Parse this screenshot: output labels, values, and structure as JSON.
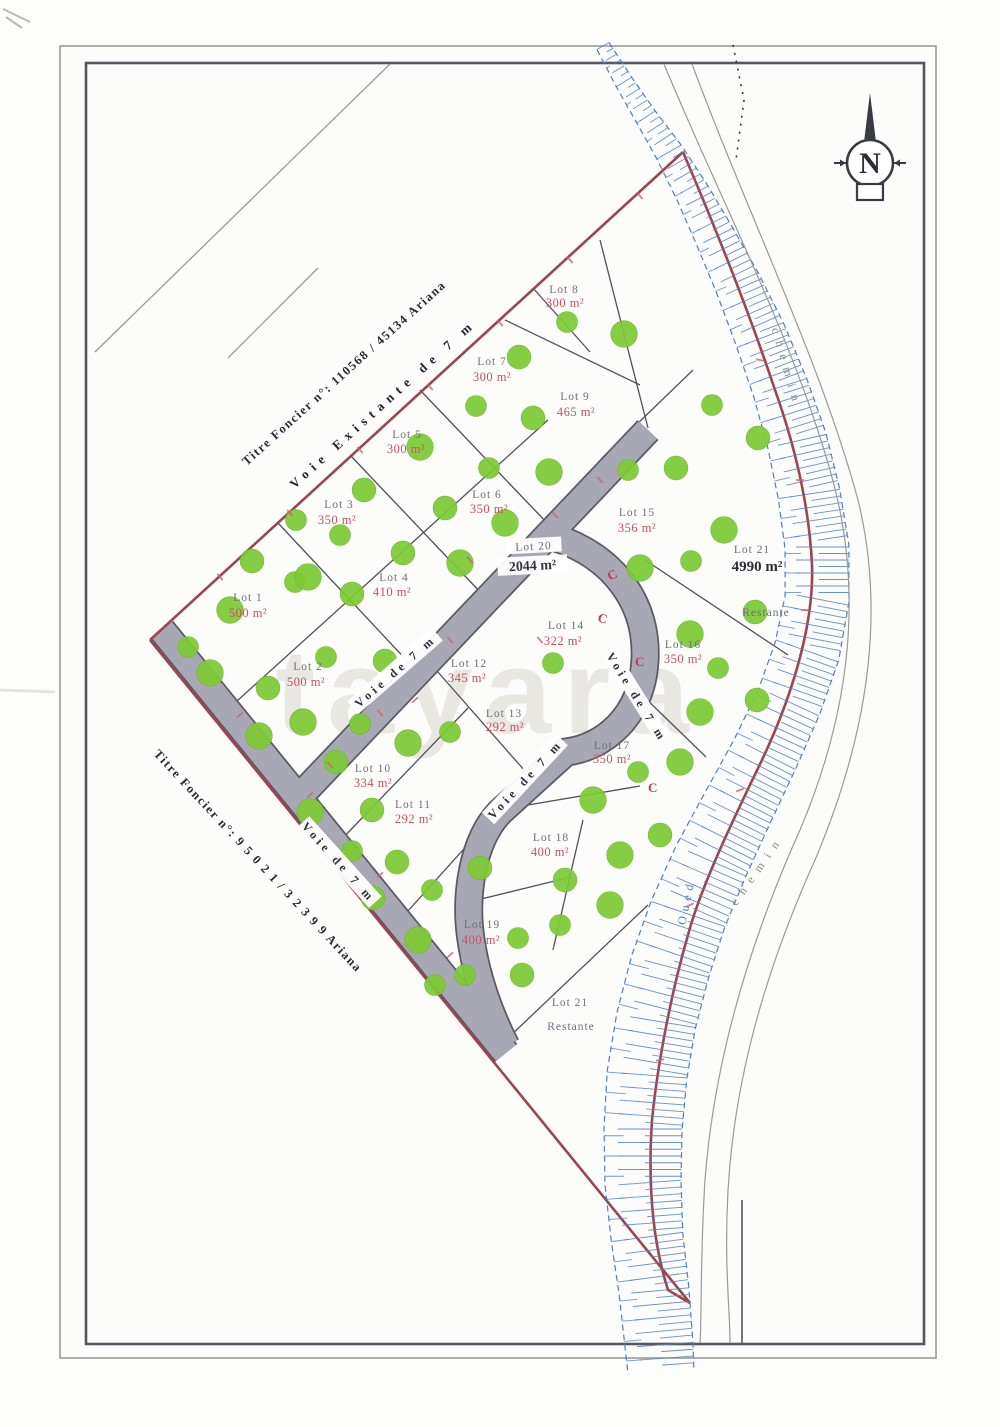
{
  "plan": {
    "watermark": "tayara",
    "north_label": "N",
    "deed_top": "Titre Foncier n°: 110568 / 45134 Ariana",
    "deed_bottom": "Titre Foncier n°: 9 5 0 2 1 / 3 2 3 9 9  Ariana",
    "road_existing": "Voie  Existante  de  7 m",
    "road_voie": "Voie de 7 m",
    "chemin": "chemin",
    "oued": "Oued",
    "restante": "Restante",
    "colors": {
      "tree_green": "#7dca36",
      "road_grey": "#a8a8b4",
      "boundary_maroon": "#9c4450",
      "river_blue": "#4f7fc2",
      "area_red": "#c85062",
      "line_dark": "#50505c"
    }
  },
  "lots": [
    {
      "name": "Lot 1",
      "area": "500 m²"
    },
    {
      "name": "Lot 2",
      "area": "500 m²"
    },
    {
      "name": "Lot 3",
      "area": "350 m²"
    },
    {
      "name": "Lot 4",
      "area": "410 m²"
    },
    {
      "name": "Lot 5",
      "area": "300 m²"
    },
    {
      "name": "Lot 6",
      "area": "350 m²"
    },
    {
      "name": "Lot 7",
      "area": "300 m²"
    },
    {
      "name": "Lot 8",
      "area": "300 m²"
    },
    {
      "name": "Lot 9",
      "area": "465 m²"
    },
    {
      "name": "Lot 10",
      "area": "334 m²"
    },
    {
      "name": "Lot 11",
      "area": "292 m²"
    },
    {
      "name": "Lot 12",
      "area": "345 m²"
    },
    {
      "name": "Lot 13",
      "area": "292 m²"
    },
    {
      "name": "Lot 14",
      "area": "322 m²"
    },
    {
      "name": "Lot 15",
      "area": "356 m²"
    },
    {
      "name": "Lot 16",
      "area": "350 m²"
    },
    {
      "name": "Lot 17",
      "area": "350 m²"
    },
    {
      "name": "Lot 18",
      "area": "400 m²"
    },
    {
      "name": "Lot 19",
      "area": "400 m²"
    },
    {
      "name": "Lot 20",
      "area": "2044 m²"
    },
    {
      "name": "Lot 21",
      "area": "4990 m²",
      "note": "Restante"
    },
    {
      "name": "Lot 21",
      "note": "Restante"
    }
  ]
}
